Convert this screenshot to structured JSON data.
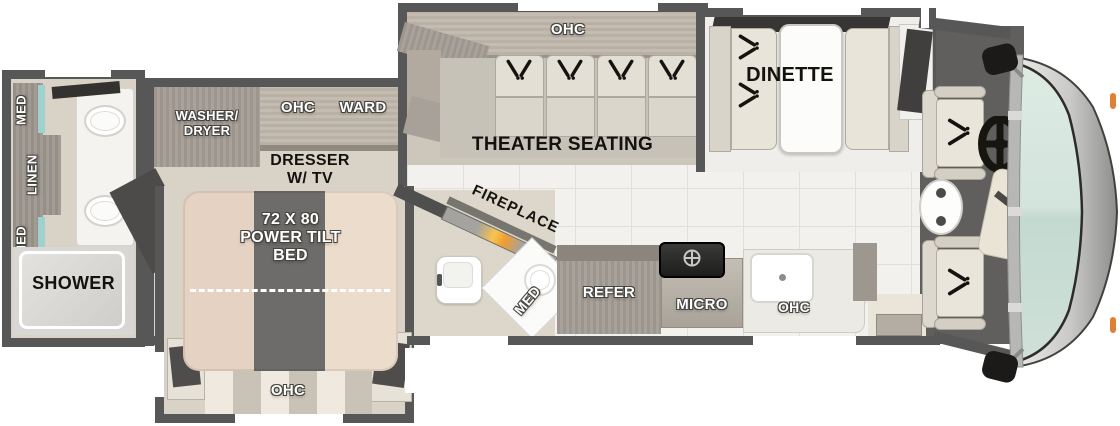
{
  "plan_title": "Class A motorhome floor plan",
  "colors": {
    "wall": "#575757",
    "floor_beige": "#d9d2c7",
    "floor_tile": "#f3f1ee",
    "cabinet_wood": "#a29b93",
    "accent_teal": "#9fd2cf",
    "windshield": "#d3e4dc",
    "fireplace_glow": "#f2a83a",
    "seat_cream": "#e8e4d9",
    "marker_orange": "#e08033"
  },
  "rear_bath": {
    "med_top": "MED",
    "linen": "LINEN",
    "med_bottom": "MED",
    "shower": "SHOWER"
  },
  "bedroom": {
    "washer_dryer": "WASHER/\nDRYER",
    "ohc": "OHC",
    "ward": "WARD",
    "dresser_tv": "DRESSER\nW/ TV",
    "bed": "72 X 80\nPOWER TILT\nBED",
    "bed_ohc": "OHC"
  },
  "half_bath": {
    "fireplace": "FIREPLACE",
    "med": "MED"
  },
  "kitchen": {
    "refer": "REFER",
    "micro": "MICRO",
    "ohc": "OHC"
  },
  "theater": {
    "ohc": "OHC",
    "label": "THEATER SEATING"
  },
  "dinette": {
    "label": "DINETTE"
  }
}
